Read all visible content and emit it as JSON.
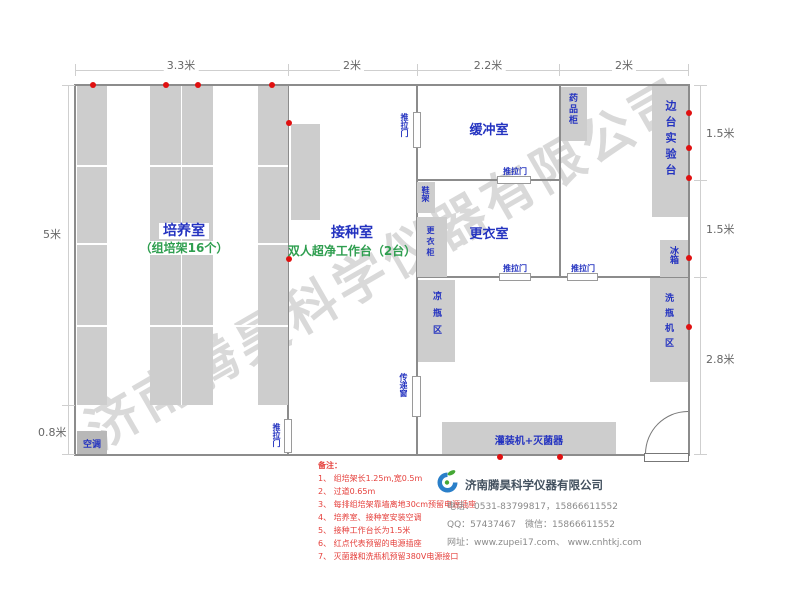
{
  "dims": {
    "top": [
      "3.3米",
      "2米",
      "2.2米",
      "2米"
    ],
    "left": [
      "5米",
      "0.8米"
    ],
    "right": [
      "1.5米",
      "1.5米",
      "2.8米"
    ]
  },
  "rooms": {
    "culture": {
      "name": "培养室",
      "sub": "（组培架16个）"
    },
    "inoculation": {
      "name": "接种室",
      "sub": "双人超净工作台（2台）"
    },
    "buffer": {
      "name": "缓冲室"
    },
    "dressing": {
      "name": "更衣室"
    }
  },
  "equipment": {
    "medicine_cabinet": "药品柜",
    "side_bench": "边台实验台",
    "fridge": "冰箱",
    "washer_area": "洗瓶机区",
    "shoe_rack": "鞋架",
    "wardrobe": "更衣柜",
    "cooling_area": "凉瓶区",
    "pass_window": "传递窗",
    "filler": "灌装机+灭菌器",
    "ac": "空调"
  },
  "labels": {
    "sliding_door": "推拉门"
  },
  "notes": {
    "title": "备注：",
    "items": [
      "1、 组培架长1.25m,宽0.5m",
      "2、 过道0.65m",
      "3、 每排组培架靠墙离地30cm预留电源插座",
      "4、 培养室、接种室安装空调",
      "5、 接种工作台长为1.5米",
      "6、 红点代表预留的电源插座",
      "7、 灭菌器和洗瓶机预留380V电源接口"
    ]
  },
  "company": {
    "name": "济南腾昊科学仪器有限公司",
    "phone": "电话：0531-83799817，15866611552",
    "qq": "QQ：57437467　微信：15866611552",
    "web": "网址：www.zupei17.com、 www.cnhtkj.com"
  },
  "watermark": "济南腾昊科学仪器有限公司",
  "colors": {
    "room_label": "#2433c0",
    "sub_label": "#2e9e4f",
    "outlet_dot": "#e01010",
    "fill_gray": "#cdcdcd",
    "wall_gray": "#8c8c8c",
    "note_red": "#e5403c"
  }
}
